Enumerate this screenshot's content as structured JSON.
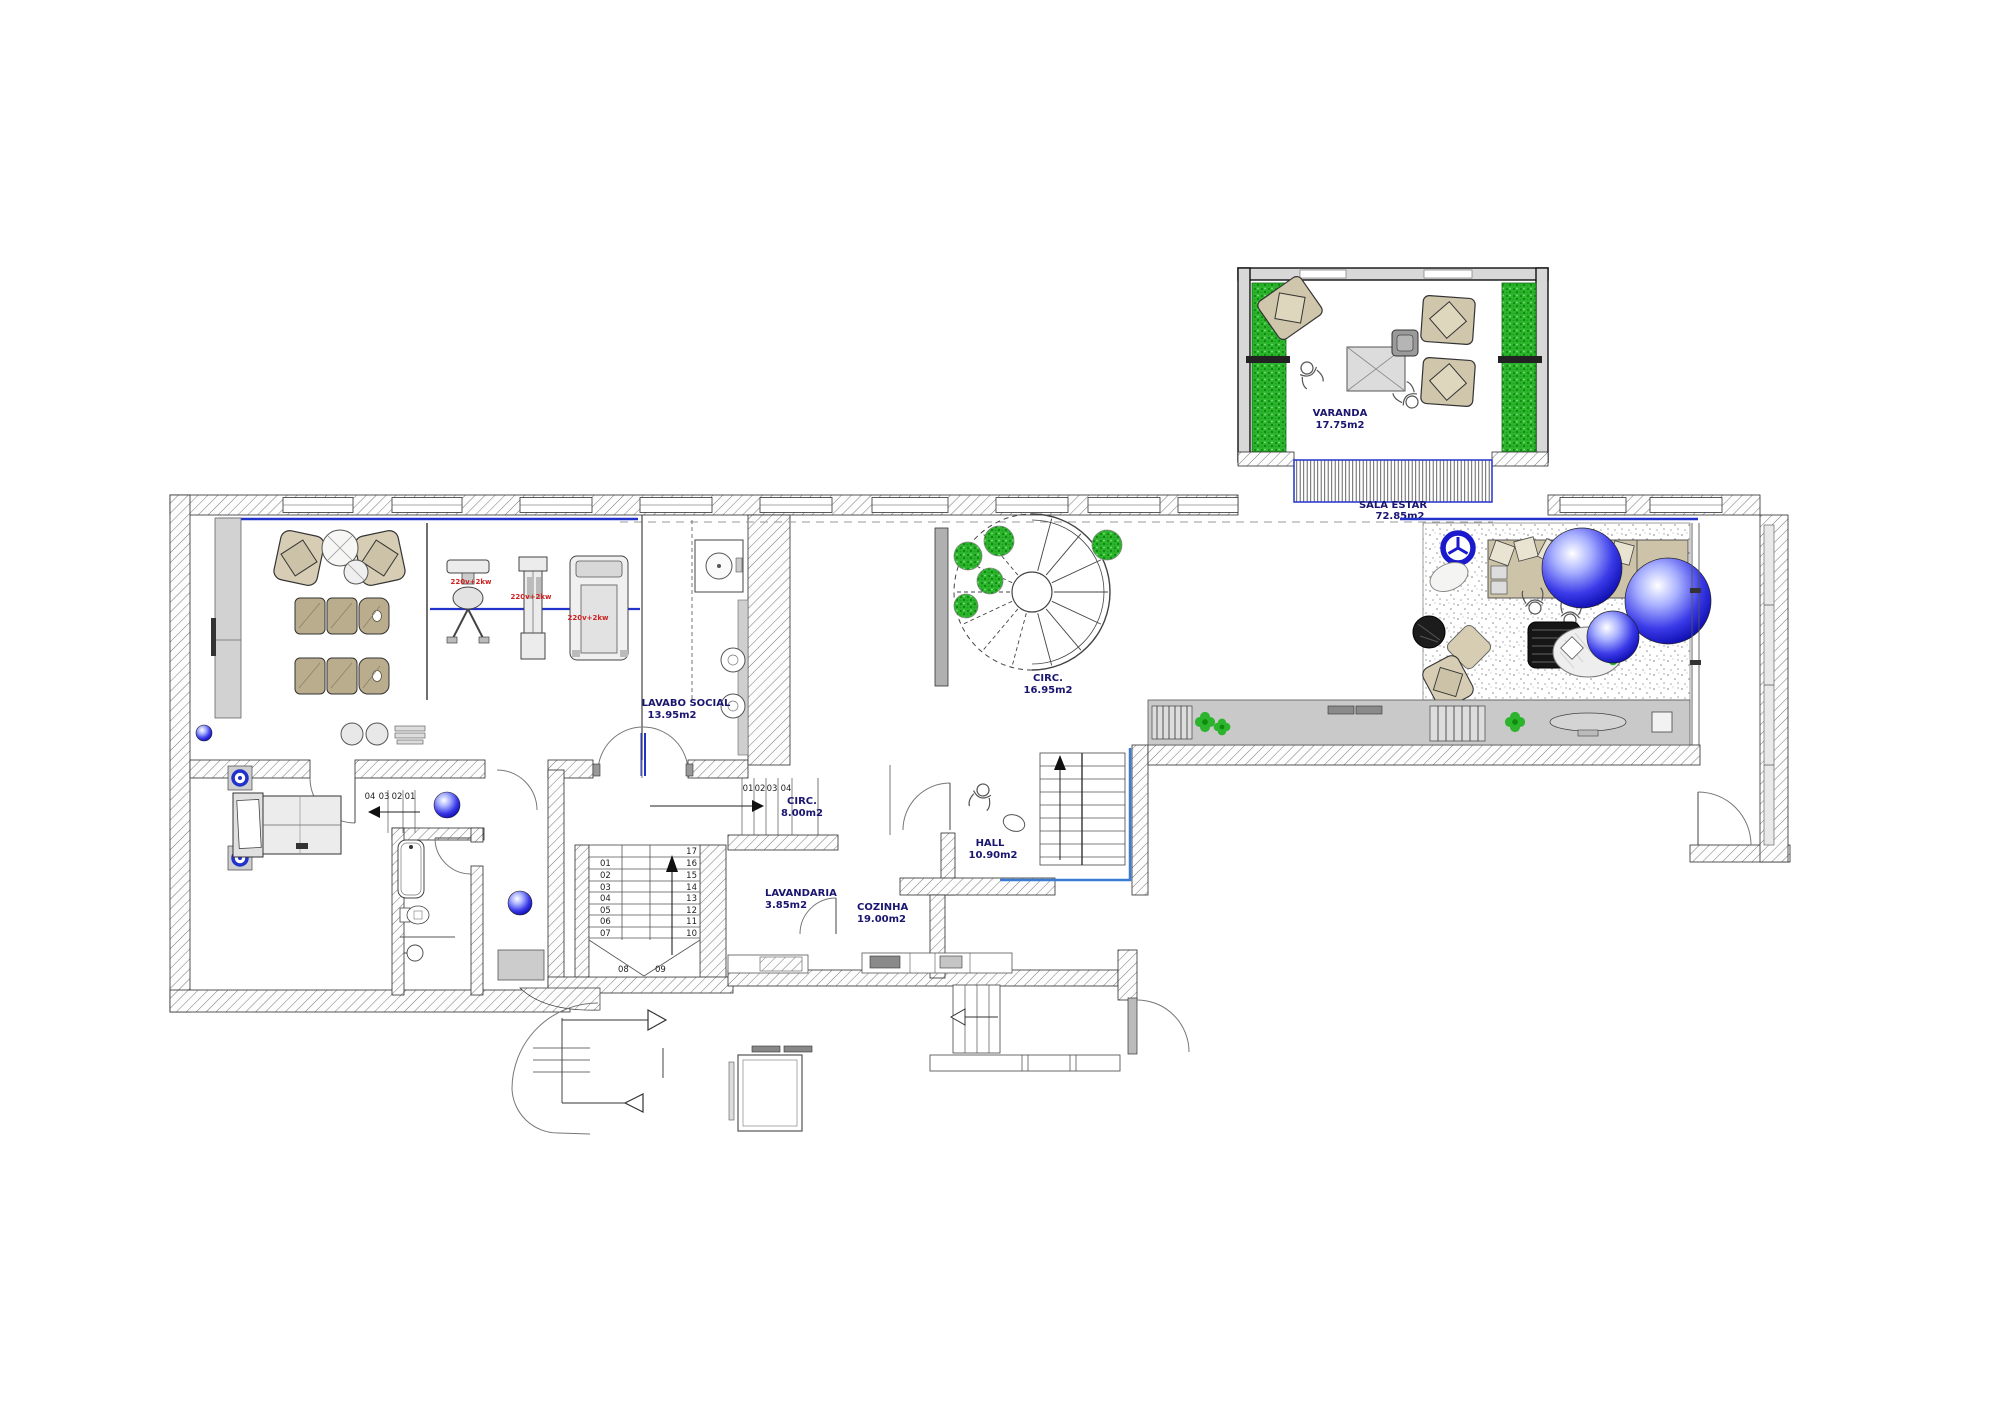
{
  "rooms": {
    "varanda": {
      "name": "VARANDA",
      "area": "17.75m2"
    },
    "sala_estar": {
      "name": "SALA ESTAR",
      "area": "72.85m2"
    },
    "lavabo_social": {
      "name": "LAVABO SOCIAL",
      "area": "13.95m2"
    },
    "circ": {
      "name": "CIRC.",
      "area": "16.95m2"
    },
    "circ2": {
      "name": "CIRC.",
      "area": "8.00m2"
    },
    "hall": {
      "name": "HALL",
      "area": "10.90m2"
    },
    "lavandaria": {
      "name": "LAVANDARIA",
      "area": "3.85m2"
    },
    "cozinha": {
      "name": "COZINHA",
      "area": "19.00m2"
    }
  },
  "annotations": {
    "power1": "220v+2kw",
    "power2": "220v+2kw",
    "power3": "220v+2kw"
  },
  "stairs": {
    "main": [
      "01",
      "02",
      "03",
      "04",
      "05",
      "06",
      "07",
      "08",
      "09",
      "10",
      "11",
      "12",
      "13",
      "14",
      "15",
      "16",
      "17"
    ],
    "corridor": [
      "01",
      "02",
      "03",
      "04"
    ],
    "bedroom": [
      "04",
      "03",
      "02",
      "01"
    ]
  },
  "colors": {
    "label_navy": "#1a1670",
    "accent_blue": "#2233cc",
    "hall_blue": "#3a7bd5",
    "plant_green": "#2cb52c",
    "power_red": "#cc2222",
    "furniture_tan": "#b9ad8e"
  }
}
